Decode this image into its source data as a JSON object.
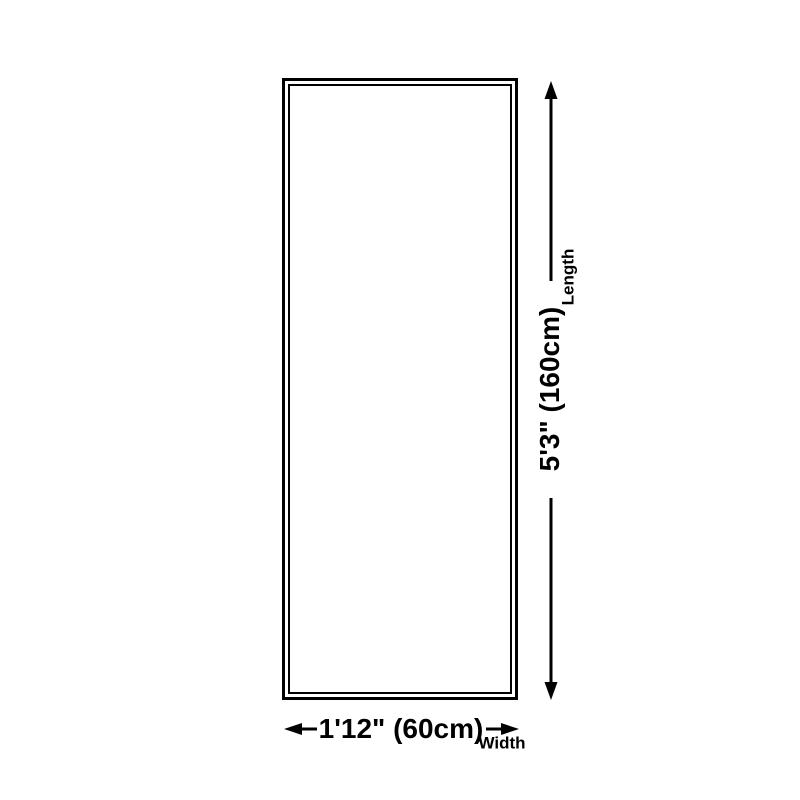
{
  "diagram": {
    "length": {
      "value": "5'3\" (160cm)",
      "axis": "Length"
    },
    "width": {
      "value": "1'12\" (60cm)",
      "axis": "Width"
    },
    "icons": {
      "length_arrows": "double-ended-vertical-arrow",
      "width_arrows": "double-ended-horizontal-arrow"
    },
    "colors": {
      "line": "#000000",
      "background": "#ffffff"
    }
  }
}
